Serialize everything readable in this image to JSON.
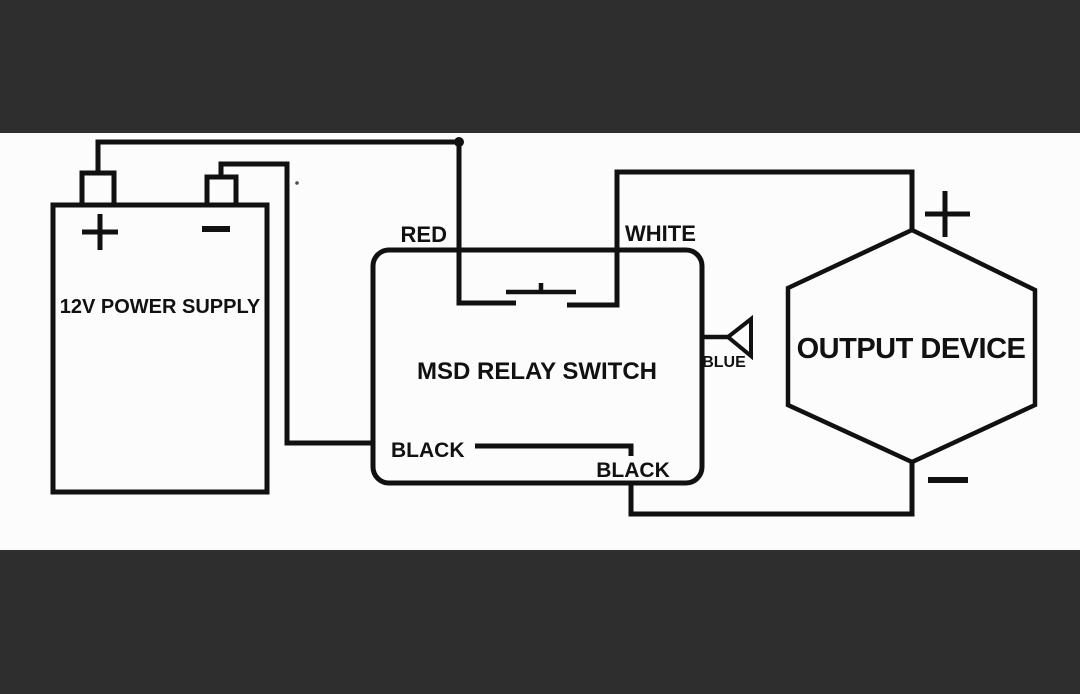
{
  "meta": {
    "type": "relay wiring diagram",
    "colors": {
      "letterbox_bar": "#2e2e2e",
      "canvas": "#fcfcfc",
      "line": "#111111"
    }
  },
  "components": {
    "power_supply": {
      "label": "12V POWER SUPPLY",
      "positive_terminal": "+",
      "negative_terminal": "−"
    },
    "relay": {
      "label": "MSD RELAY SWITCH"
    },
    "output_device": {
      "label": "OUTPUT DEVICE",
      "positive_terminal": "+",
      "negative_terminal": "−"
    }
  },
  "wires": {
    "red": "RED",
    "white": "WHITE",
    "black_supply": "BLACK",
    "black_ground": "BLACK",
    "blue": "BLUE"
  }
}
